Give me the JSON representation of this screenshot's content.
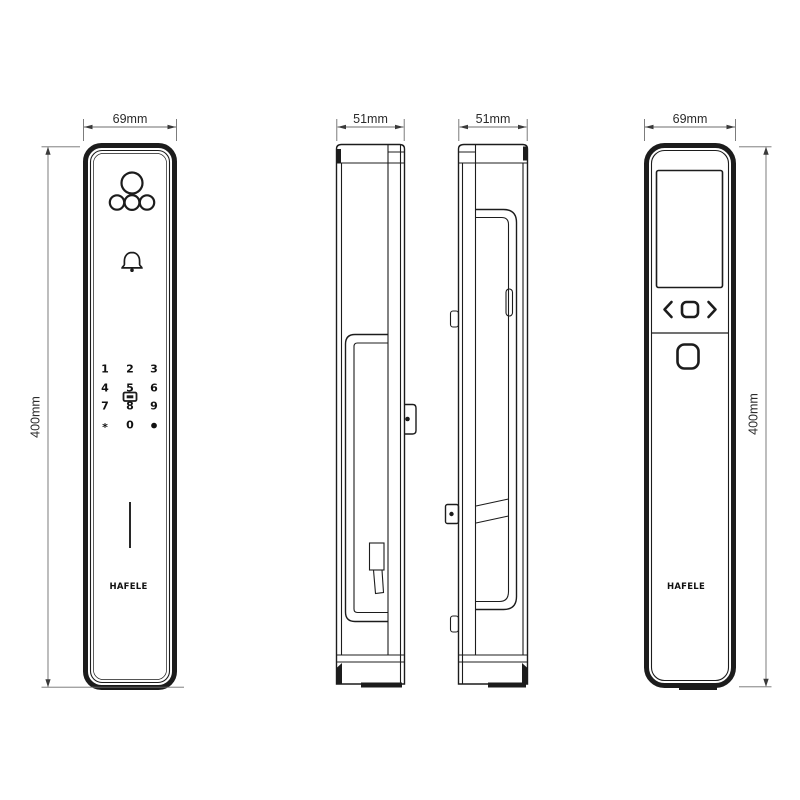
{
  "drawing": {
    "background": "#ffffff",
    "ink_color": "#1c1c1c",
    "dimension_color": "#2b2b2b",
    "brand": "HAFELE",
    "views": {
      "front": {
        "name": "front-exterior-panel",
        "width_label": "69mm",
        "height_label": "400mm",
        "icons": [
          "camera-lens",
          "led-indicators",
          "doorbell-icon",
          "card-reader-icon",
          "speaker-slot",
          "brand-logo"
        ],
        "keypad_rows": [
          [
            "1",
            "2",
            "3"
          ],
          [
            "4",
            "5",
            "6"
          ],
          [
            "7",
            "8",
            "9"
          ],
          [
            "*",
            "0",
            "●"
          ]
        ]
      },
      "side_a": {
        "name": "left-profile",
        "width_label": "51mm",
        "icons": [
          "pull-handle-profile",
          "key-cylinder",
          "latch-bracket"
        ]
      },
      "side_b": {
        "name": "right-profile",
        "width_label": "51mm",
        "icons": [
          "pull-handle-profile",
          "strike-fitting",
          "mount-clips"
        ]
      },
      "back": {
        "name": "back-interior-panel",
        "width_label": "69mm",
        "height_label": "400mm",
        "icons": [
          "display-screen",
          "nav-left-icon",
          "nav-ok-icon",
          "nav-right-icon",
          "thumb-turn-button",
          "brand-logo"
        ]
      }
    }
  }
}
